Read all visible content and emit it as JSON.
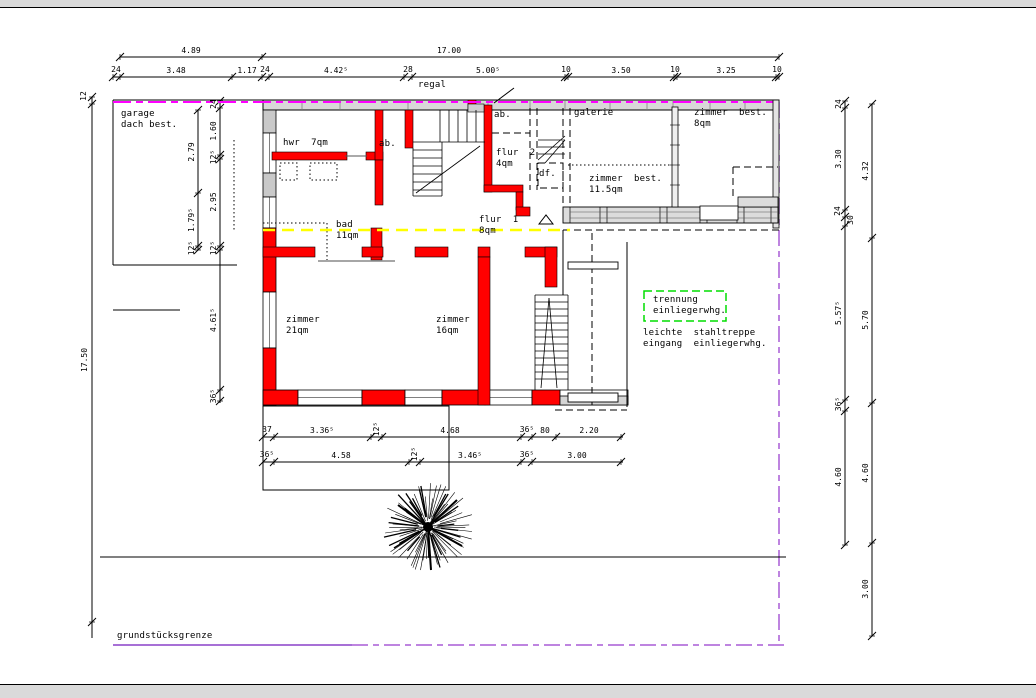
{
  "drawing": {
    "shelf_label": "regal",
    "boundary_label": "grundstücksgrenze",
    "notes": {
      "separation_line1": "trennung",
      "separation_line2": "einliegerwhg.",
      "stair_note_line1": "leichte  stahltreppe",
      "stair_note_line2": "eingang  einliegerwhg."
    },
    "rooms": {
      "garage": {
        "line1": "garage",
        "line2": "dach best."
      },
      "hwr": {
        "label": "hwr  7qm"
      },
      "ab_left": {
        "label": "ab."
      },
      "ab_top": {
        "label": "ab."
      },
      "flur2": {
        "line1": "flur  2",
        "line2": "4qm"
      },
      "df": {
        "label": "df."
      },
      "galerie": {
        "label": "galerie"
      },
      "zimmer_best_8": {
        "line1": "zimmer  best.",
        "line2": "8qm"
      },
      "zimmer_best_11": {
        "line1": "zimmer  best.",
        "line2": "11.5qm"
      },
      "bad": {
        "line1": "bad",
        "line2": "11qm"
      },
      "flur1": {
        "line1": "flur  1",
        "line2": "8qm"
      },
      "zimmer21": {
        "line1": "zimmer",
        "line2": "21qm"
      },
      "zimmer16": {
        "line1": "zimmer",
        "line2": "16qm"
      }
    },
    "dimensions": {
      "top_overall": [
        "4.89",
        "17.00"
      ],
      "top_detail": [
        "24",
        "3.48",
        "1.17",
        "24",
        "4.42⁵",
        "28",
        "5.00⁵",
        "10",
        "3.50",
        "10",
        "3.25",
        "10"
      ],
      "left_outer": [
        "12",
        "17.50"
      ],
      "left_a": [
        "2.79",
        "1.79⁵",
        "12⁵"
      ],
      "left_b": [
        "24",
        "1.60",
        "12⁵",
        "2.95",
        "12⁵",
        "4.61⁵",
        "36⁵"
      ],
      "right_inner": [
        "24",
        "3.30",
        "24",
        "30",
        "5.57⁵",
        "36⁵",
        "4.60"
      ],
      "right_outer": [
        "4.32",
        "5.70",
        "4.60",
        "3.00"
      ],
      "bottom_r1": [
        "37",
        "3.36⁵",
        "12⁵",
        "4.68",
        "36⁵",
        "80",
        "2.20"
      ],
      "bottom_r2": [
        "36⁵",
        "4.58",
        "12⁵",
        "3.46⁵",
        "36⁵",
        "3.00"
      ]
    },
    "colors": {
      "new_wall_red": "#ff0000",
      "existing_wall_gray": "#d8d8d8",
      "boundary_magenta": "#ff00ff",
      "boundary_purple": "#a85cd6",
      "section_yellow": "#ffff00",
      "separation_green": "#00dd00"
    }
  }
}
